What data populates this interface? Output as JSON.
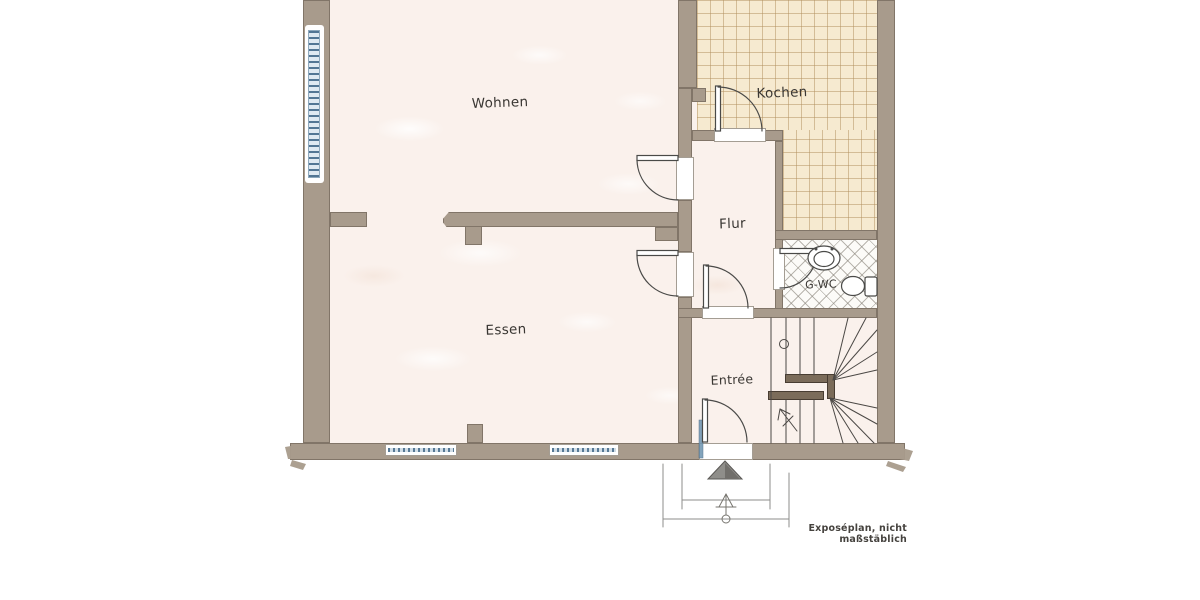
{
  "plan": {
    "caption": "Exposéplan, nicht maßstäblich",
    "rooms": {
      "wohnen": {
        "label": "Wohnen"
      },
      "essen": {
        "label": "Essen"
      },
      "kochen": {
        "label": "Kochen"
      },
      "flur": {
        "label": "Flur"
      },
      "gwc": {
        "label": "G-WC"
      },
      "entree": {
        "label": "Entrée"
      }
    },
    "colors": {
      "wall": "#a89b8c",
      "floor": "#faf1ec",
      "kitchen_tile": "#f6ead0",
      "tile_line": "#c8ab7e",
      "window_glass": "#6d93b0",
      "line": "#4a4a48"
    }
  }
}
